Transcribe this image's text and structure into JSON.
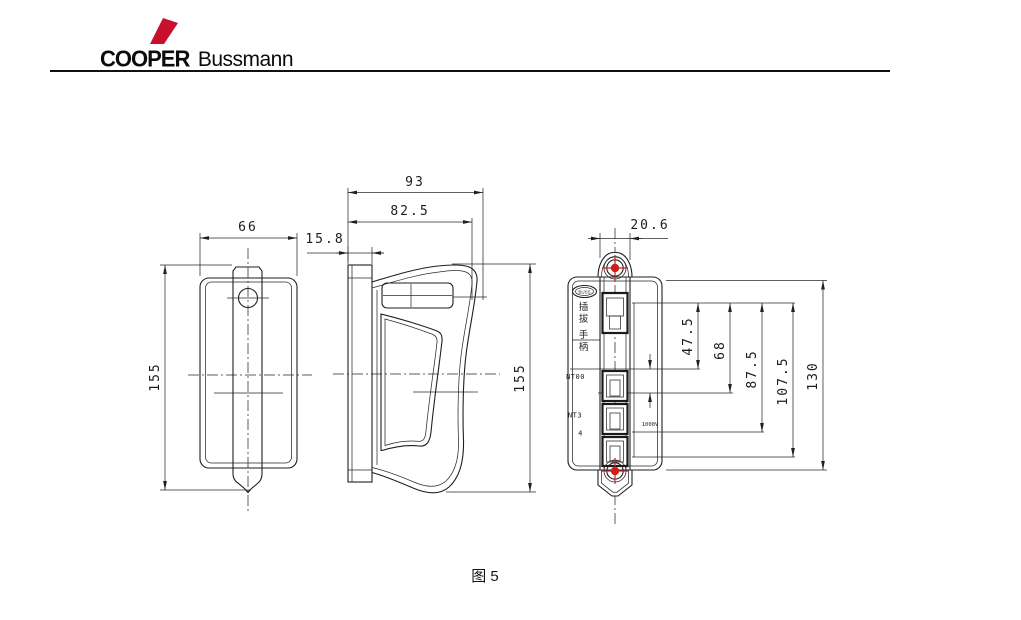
{
  "brand": {
    "primary": "COOPER",
    "secondary": "Bussmann"
  },
  "caption": "图 5",
  "front_view": {
    "dim_width": "66",
    "dim_height": "155"
  },
  "side_view": {
    "dim_overall": "93",
    "dim_grip": "82.5",
    "dim_plate": "15.8",
    "dim_height": "155"
  },
  "rear_view": {
    "dim_handle_width": "20.6",
    "dim_a": "47.5",
    "dim_b": "68",
    "dim_c": "87.5",
    "dim_d": "107.5",
    "dim_e": "130",
    "label_chars": [
      "插",
      "拔",
      "手",
      "柄"
    ],
    "label_size_top": "NT00",
    "label_size_mid": "NT3",
    "label_size_sub": "4",
    "label_voltage": "1000V",
    "badge_text": "BUSS"
  },
  "colors": {
    "accent_red": "#c8102e",
    "line_color": "#1f1f1f"
  }
}
